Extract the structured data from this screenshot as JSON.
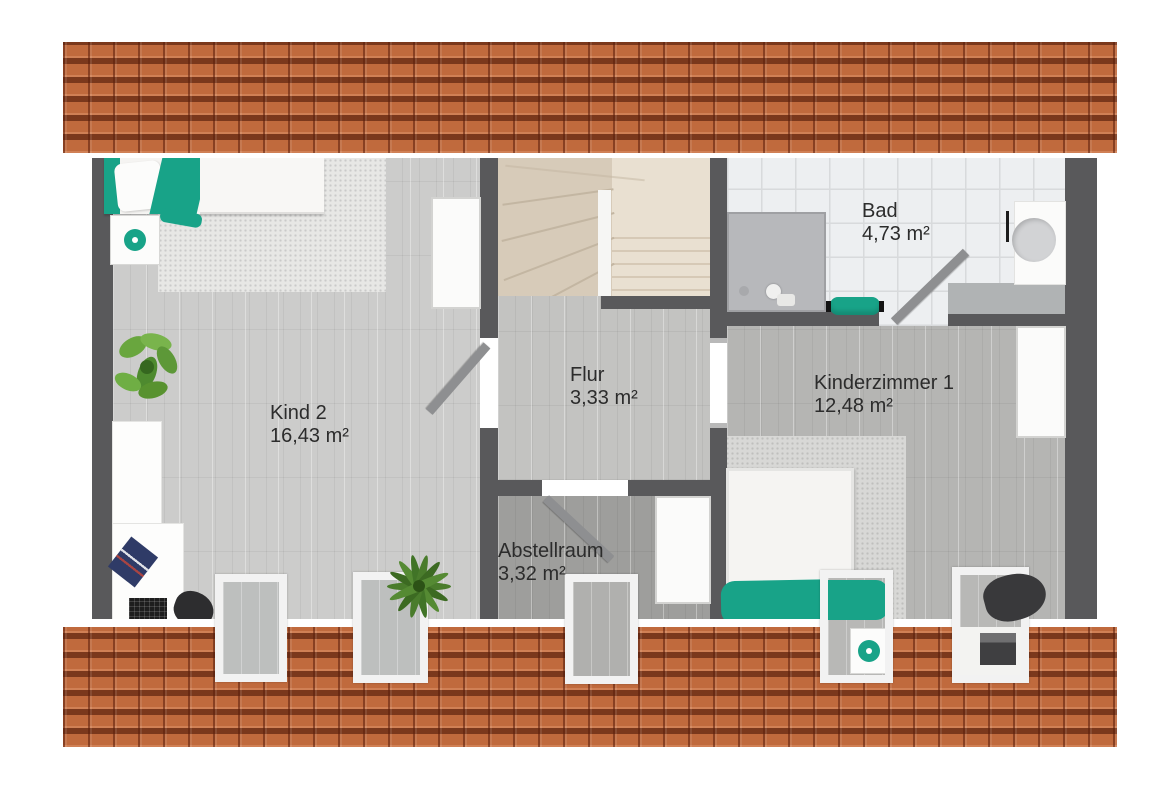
{
  "rooms": {
    "kind2": {
      "name": "Kind 2",
      "area": "16,43 m²"
    },
    "flur": {
      "name": "Flur",
      "area": "3,33 m²"
    },
    "bad": {
      "name": "Bad",
      "area": "4,73 m²"
    },
    "kinderzimmer1": {
      "name": "Kinderzimmer 1",
      "area": "12,48 m²"
    },
    "abstellraum": {
      "name": "Abstellraum",
      "area": "3,32 m²"
    }
  },
  "colors": {
    "accent_teal": "#18a388",
    "roof_tile": "#c06a3d",
    "wall": "#59595b",
    "stairs_left": "#d7cbb9",
    "stairs_right": "#e9e0d1",
    "label_text": "#2c2c2c"
  }
}
